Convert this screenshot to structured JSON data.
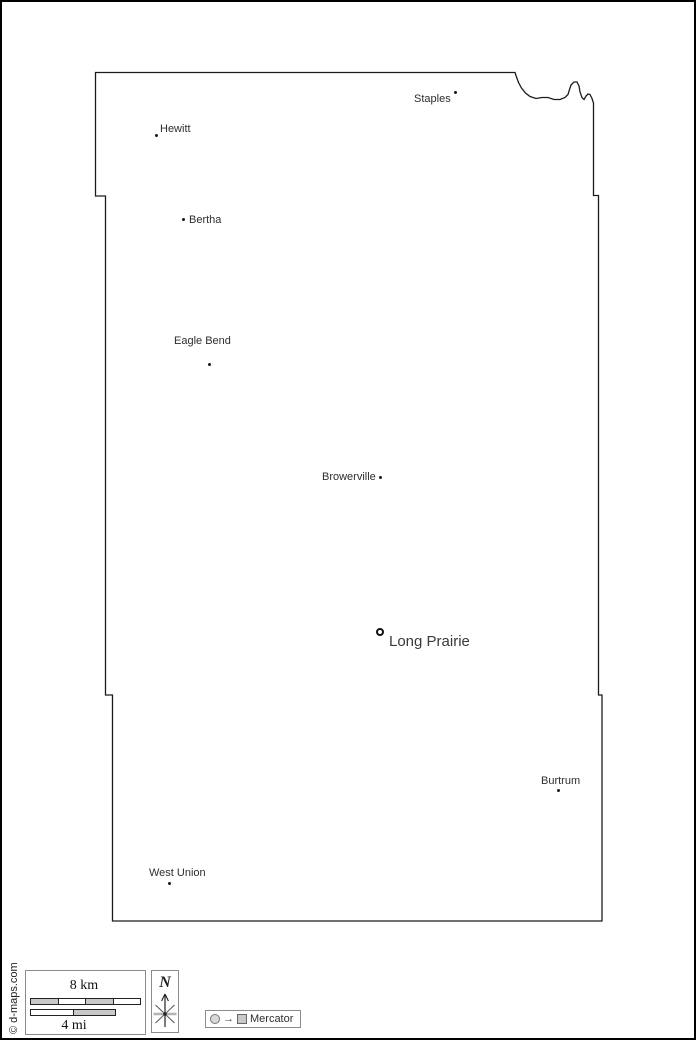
{
  "map": {
    "type": "county-outline-map",
    "cities": [
      {
        "name": "Staples",
        "marker": "dot"
      },
      {
        "name": "Hewitt",
        "marker": "dot"
      },
      {
        "name": "Bertha",
        "marker": "dot"
      },
      {
        "name": "Eagle Bend",
        "marker": "dot"
      },
      {
        "name": "Browerville",
        "marker": "dot"
      },
      {
        "name": "Long Prairie",
        "marker": "county-seat-ring"
      },
      {
        "name": "Burtrum",
        "marker": "dot"
      },
      {
        "name": "West Union",
        "marker": "dot"
      }
    ]
  },
  "legend": {
    "scale_km_label": "8 km",
    "scale_mi_label": "4 mi",
    "north_label": "N",
    "arrow_glyph": "→",
    "projection_label": "Mercator",
    "copyright": "© d-maps.com"
  },
  "colors": {
    "outline": "#1c1c1c",
    "label": "#2e2e2e",
    "scale_fill": "#c8c8c8",
    "frame": "#000000"
  }
}
